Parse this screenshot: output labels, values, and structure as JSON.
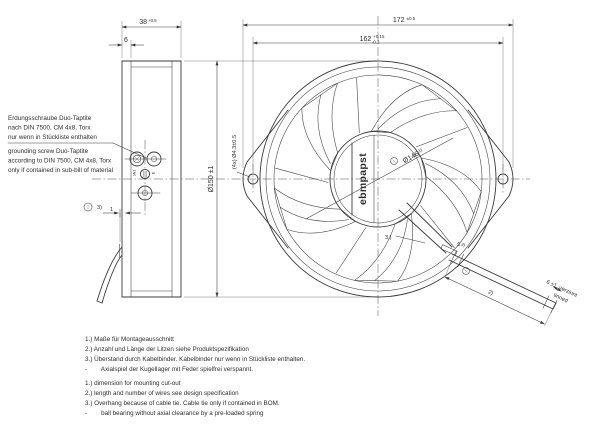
{
  "dimensions": {
    "depth": {
      "value": "38",
      "tol": "+0.5"
    },
    "flange_width": {
      "value": "6"
    },
    "overall_width": {
      "value": "172",
      "tol": "±0.5"
    },
    "mounting": {
      "value": "162",
      "tol_upper": "+0.15",
      "tol_lower": "-0.3"
    },
    "outer_diameter": "Ø150 ±1",
    "mounting_holes": "(4x) Ø4.3±0.5",
    "cutout_diameter": {
      "value": "Ø146",
      "note": "1)"
    },
    "overhang": {
      "value": "1",
      "note": "3)"
    },
    "cable_tie_note": "3.)",
    "sleeve": {
      "value": "5",
      "note": "2)"
    },
    "cable_length_note": "2)",
    "tinned": {
      "value": "6 ±1",
      "de": "verzinnt",
      "en": "tinned"
    }
  },
  "branding": {
    "logo": "ebmpapst"
  },
  "terminals": {
    "left": "3N1",
    "right": "E"
  },
  "grounding_note": {
    "de": [
      "Erdungsschraube Duo-Taptite",
      "nach DIN 7500, CM 4x8, Torx",
      "nur wenn in Stückliste enthalten"
    ],
    "en": [
      "grounding screw Duo-Taptite",
      "according to DIN 7500, CM 4x8, Torx",
      "only if contained in sub-bill of material"
    ]
  },
  "footnotes": {
    "de": [
      "1.) Maße für Montageausschnitt",
      "2.) Anzahl und Länge der Litzen siehe Produktspezifikation",
      "3.) Überstand durch Kabelbinder. Kabelbinder nur wenn in Stückliste enthalten.",
      "-        Axialspiel der Kugellager mit Feder spielfrei verspannt."
    ],
    "en": [
      "1.) dimension for mounting cut-out",
      "2.) length and number of wires see design specification",
      "3.) Overhang because of cable tie. Cable tie only if contained in BOM.",
      "-        ball bearing without axial clearance by a pre-loaded spring"
    ]
  }
}
